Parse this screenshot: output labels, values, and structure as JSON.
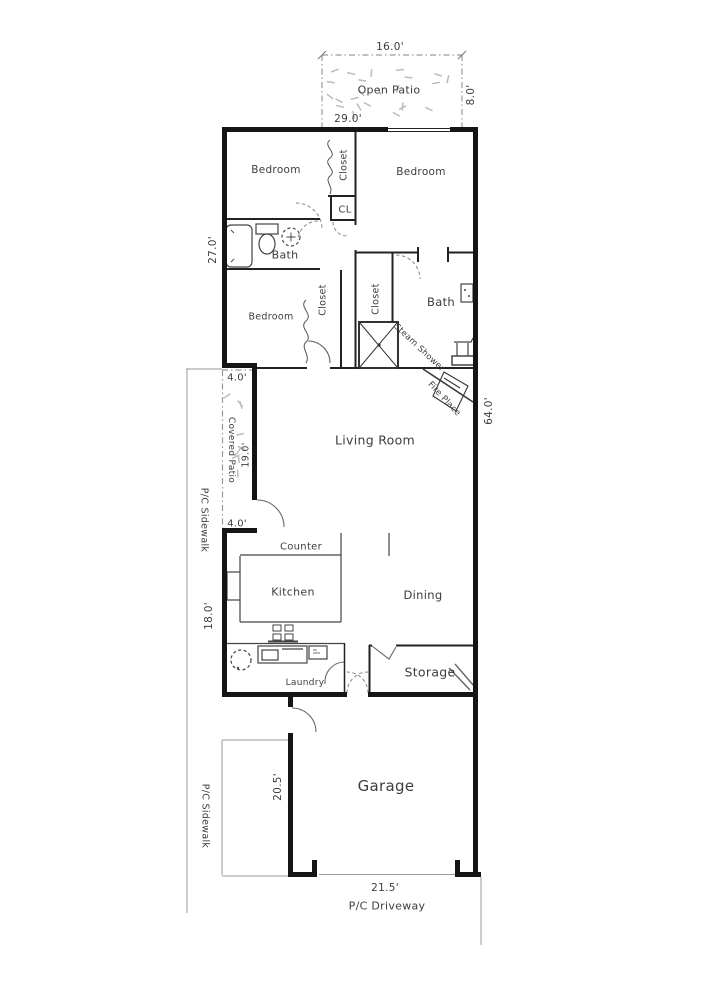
{
  "plan_title": "Single family residence floor plan",
  "labels": {
    "dim_16": "16.0'",
    "open_patio": "Open Patio",
    "dim_8": "8.0'",
    "dim_29": "29.0'",
    "bedroom_top_left": "Bedroom",
    "closet_top": "Closet",
    "bedroom_top_right": "Bedroom",
    "closet_small": "CL",
    "dim_27": "27.0'",
    "bath_left": "Bath",
    "bedroom_mid": "Bedroom",
    "closet_mid_left": "Closet",
    "closet_mid_right": "Closet",
    "bath_right": "Bath",
    "steam_shower": "Steam Shower",
    "fire_place": "Fire Place",
    "dim_64": "64.0'",
    "dim_4_top": "4.0'",
    "sidewalk_upper": "P/C Sidewalk",
    "covered_patio": "Covered Patio",
    "dim_19": "19.0'",
    "dim_4_bottom": "4.0'",
    "living_room": "Living Room",
    "counter": "Counter",
    "kitchen": "Kitchen",
    "dining": "Dining",
    "dim_18": "18.0'",
    "laundry": "Laundry",
    "storage": "Storage",
    "dim_20_5": "20.5'",
    "garage": "Garage",
    "sidewalk_lower": "P/C Sidewalk",
    "dim_21_5": "21.5'",
    "driveway": "P/C Driveway"
  },
  "colors": {
    "wall": "#151515",
    "interior_line": "#555555",
    "site_line": "#9a9a9a",
    "text": "#3d3d3d",
    "grass": "#bcbcbc"
  }
}
